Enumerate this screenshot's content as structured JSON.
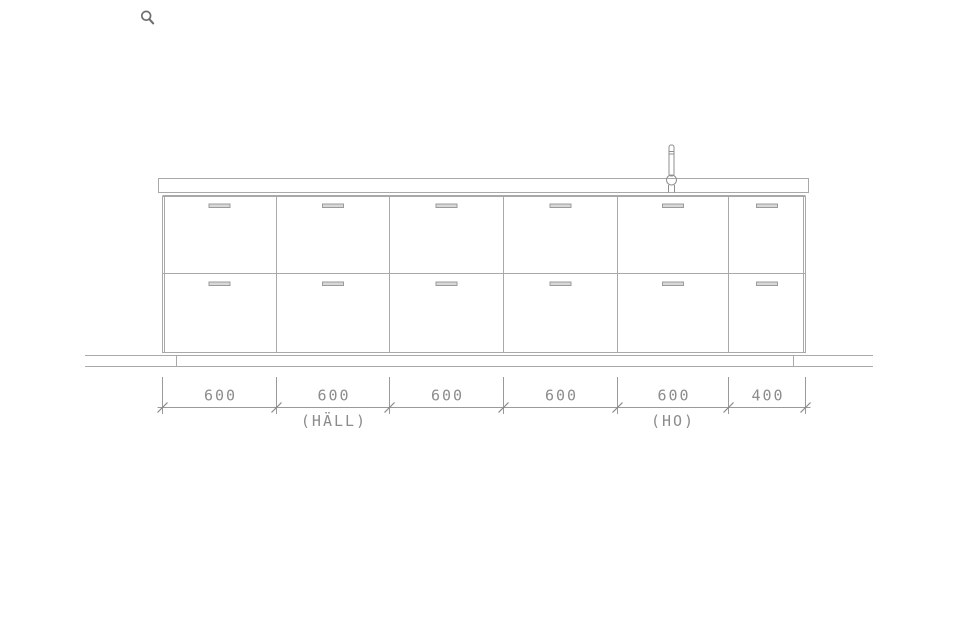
{
  "viewer": {
    "zoom_icon": "magnifying-glass"
  },
  "drawing": {
    "subject": "kitchen base cabinet elevation",
    "colors": {
      "line": "#a9a9a9",
      "dim_line": "#9a9a9a",
      "dim_text": "#8c8c8c",
      "handle_fill": "#d8d8d8",
      "faucet_line": "#8f8f8f"
    },
    "cabinet": {
      "columns": 6,
      "rows": 2,
      "handle_count": 12,
      "has_faucet": true
    },
    "dimensions": {
      "values": [
        "600",
        "600",
        "600",
        "600",
        "600",
        "400"
      ],
      "annotations": {
        "hob": "(HÄLL)",
        "sink": "(HO)"
      }
    }
  }
}
